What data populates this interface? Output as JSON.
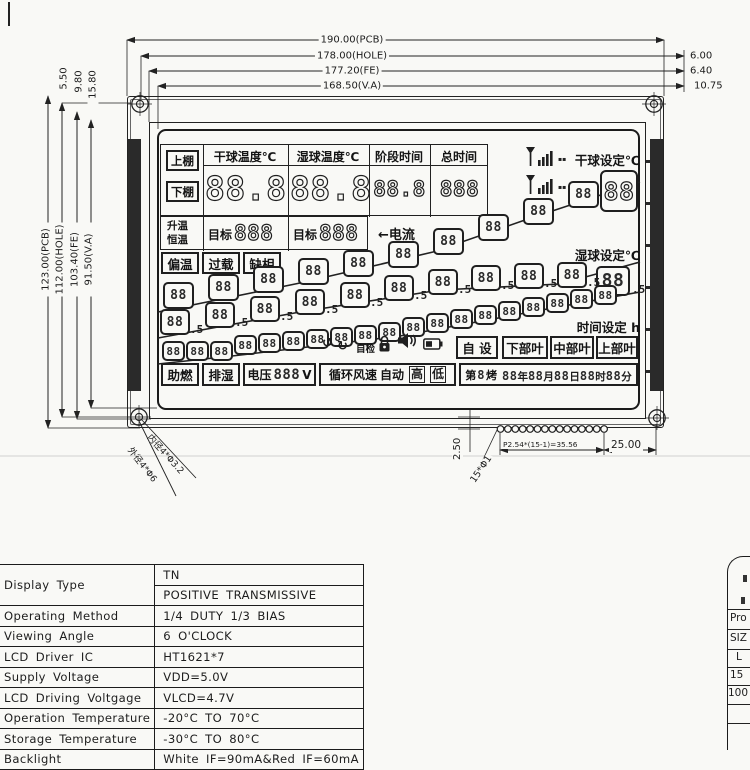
{
  "dims": {
    "top": [
      {
        "label": "190.00(PCB)"
      },
      {
        "label": "178.00(HOLE)",
        "offset": "6.00"
      },
      {
        "label": "177.20(FE)",
        "offset": "6.40"
      },
      {
        "label": "168.50(V.A)",
        "offset": "10.75"
      }
    ],
    "left": [
      "123.00(PCB)",
      "112.00(HOLE)",
      "103.40(FE)",
      "91.50(V.A)"
    ],
    "left_top": [
      "5.50",
      "9.80",
      "15.80"
    ],
    "bottom": {
      "gap": "2.50",
      "pins": "15*Φ1",
      "pitch": "P2.54*(15-1)=35.56",
      "margin": "25.00"
    },
    "holes": {
      "inner": "内径4*Φ3.2",
      "outer": "外径4*Φ6"
    }
  },
  "lcd": {
    "shelf_upper": "上棚",
    "shelf_lower": "下棚",
    "cols": [
      {
        "header": "干球温度℃",
        "value": "88.8"
      },
      {
        "header": "湿球温度℃",
        "value": "88.8"
      },
      {
        "header": "阶段时间",
        "value": "88.8"
      },
      {
        "header": "总时间",
        "value": "888"
      }
    ],
    "mode_rise": "升温",
    "mode_hold": "恒温",
    "target1_label": "目标",
    "target1_value": "888",
    "target2_label": "目标",
    "target2_value": "888",
    "current_label": "←电流",
    "signal1_label": "▪▪",
    "signal2_label": "▪▪",
    "alarms": [
      "偏温",
      "过载",
      "缺相"
    ],
    "set_dry_label": "干球设定℃",
    "set_dry_value": "88",
    "set_wet_label": "湿球设定℃",
    "set_wet_value": "88",
    "set_wet_suffix": ".5",
    "set_time_label": "时间设定 h",
    "stair_dry": [
      "88",
      "88",
      "88",
      "88",
      "88",
      "88",
      "88",
      "88",
      "88",
      "88"
    ],
    "stair_wet": [
      "88",
      "88",
      "88",
      "88",
      "88",
      "88",
      "88",
      "88",
      "88",
      "88"
    ],
    "stair_wet_suffix": ".5",
    "stair_time": [
      "88",
      "88",
      "88",
      "88",
      "88",
      "88",
      "88",
      "88",
      "88",
      "88",
      "88",
      "88",
      "88",
      "88",
      "88",
      "88",
      "88",
      "88",
      "88"
    ],
    "status": {
      "rotate_left": "↺",
      "rotate_right": "↻",
      "self_check": "自检"
    },
    "leaf": {
      "auto_set": "自 设",
      "lower": "下部叶",
      "middle": "中部叶",
      "upper": "上部叶"
    },
    "bottom": {
      "boost": "助燃",
      "dehum": "排湿",
      "volt_label": "电压",
      "volt_value": "888",
      "volt_unit": "V",
      "fan_label": "循环风速",
      "fan_auto": "自动",
      "fan_high": "高",
      "fan_low": "低",
      "batch_prefix": "第",
      "batch_digit": "8",
      "batch_suffix": "烤",
      "datetime": [
        {
          "v": "88",
          "u": "年"
        },
        {
          "v": "88",
          "u": "月"
        },
        {
          "v": "88",
          "u": "日"
        },
        {
          "v": "88",
          "u": "时"
        },
        {
          "v": "88",
          "u": "分"
        }
      ]
    }
  },
  "spec_table": {
    "rows": [
      {
        "label": "Display  Type",
        "values": [
          "TN",
          "POSITIVE  TRANSMISSIVE"
        ]
      },
      {
        "label": "Operating  Method",
        "values": [
          "1/4  DUTY    1/3  BIAS"
        ]
      },
      {
        "label": "Viewing  Angle",
        "values": [
          "6  O'CLOCK"
        ]
      },
      {
        "label": "LCD  Driver  IC",
        "values": [
          "HT1621*7"
        ]
      },
      {
        "label": "Supply  Voltage",
        "values": [
          "VDD=5.0V"
        ]
      },
      {
        "label": "LCD  Driving  Voltgage",
        "values": [
          "VLCD=4.7V"
        ]
      },
      {
        "label": "Operation  Temperature",
        "values": [
          "-20°C  TO  70°C"
        ]
      },
      {
        "label": "Storage  Temperature",
        "values": [
          "-30°C  TO  80°C"
        ]
      },
      {
        "label": "Backlight",
        "values": [
          "White  IF=90mA&Red  IF=60mA"
        ]
      }
    ]
  },
  "side_table": {
    "fragments": [
      "Pro",
      "SIZ",
      "L",
      "15",
      "100"
    ]
  }
}
